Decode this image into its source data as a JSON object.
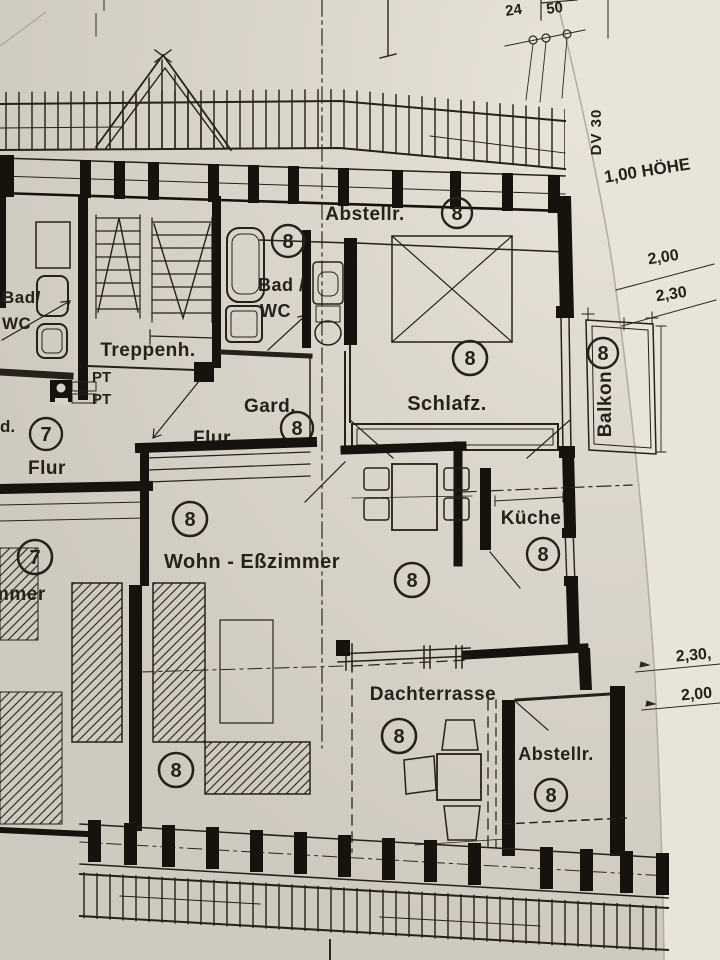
{
  "annotations": {
    "top_num_left": "24",
    "top_num_right": "50",
    "dv_note": "DV 30",
    "hoehe_note": "1,00 HÖHE",
    "dim_200_top": "2,00",
    "dim_230_top": "2,30",
    "dim_230_mid": "2,30,",
    "dim_200_mid": "2,00"
  },
  "rooms": {
    "abstell_top": {
      "name": "Abstellr.",
      "unit": "8"
    },
    "bad8": {
      "line1": "Bad /",
      "line2": "WC",
      "unit": "8"
    },
    "bad7": {
      "line1": "Bad/",
      "line2": "WC"
    },
    "treppenhaus": {
      "name": "Treppenh.",
      "pt_upper": "PT",
      "pt_lower": "PT"
    },
    "gard": {
      "name": "Gard.",
      "unit": "8"
    },
    "flur8": {
      "name": "Flur"
    },
    "flur7": {
      "name": "Flur",
      "unit": "7",
      "fragment_left": "d."
    },
    "schlafzimmer": {
      "name": "Schlafz.",
      "unit": "8"
    },
    "balkon": {
      "name": "Balkon",
      "unit": "8"
    },
    "kueche": {
      "name": "Küche",
      "unit": "8"
    },
    "wohn_esszimmer": {
      "name": "Wohn - Eßzimmer",
      "unit_nw": "8",
      "unit_center": "8",
      "unit_sw": "8"
    },
    "zimmer7": {
      "fragment": "mmer",
      "unit": "7"
    },
    "dachterrasse": {
      "name": "Dachterrasse",
      "unit": "8"
    },
    "abstell_bottom": {
      "name": "Abstellr.",
      "unit": "8"
    }
  },
  "colors": {
    "paper": "#d8d3c9",
    "paper_light": "#e7e2d8",
    "ink": "#26211a",
    "wall": "#16120d"
  }
}
